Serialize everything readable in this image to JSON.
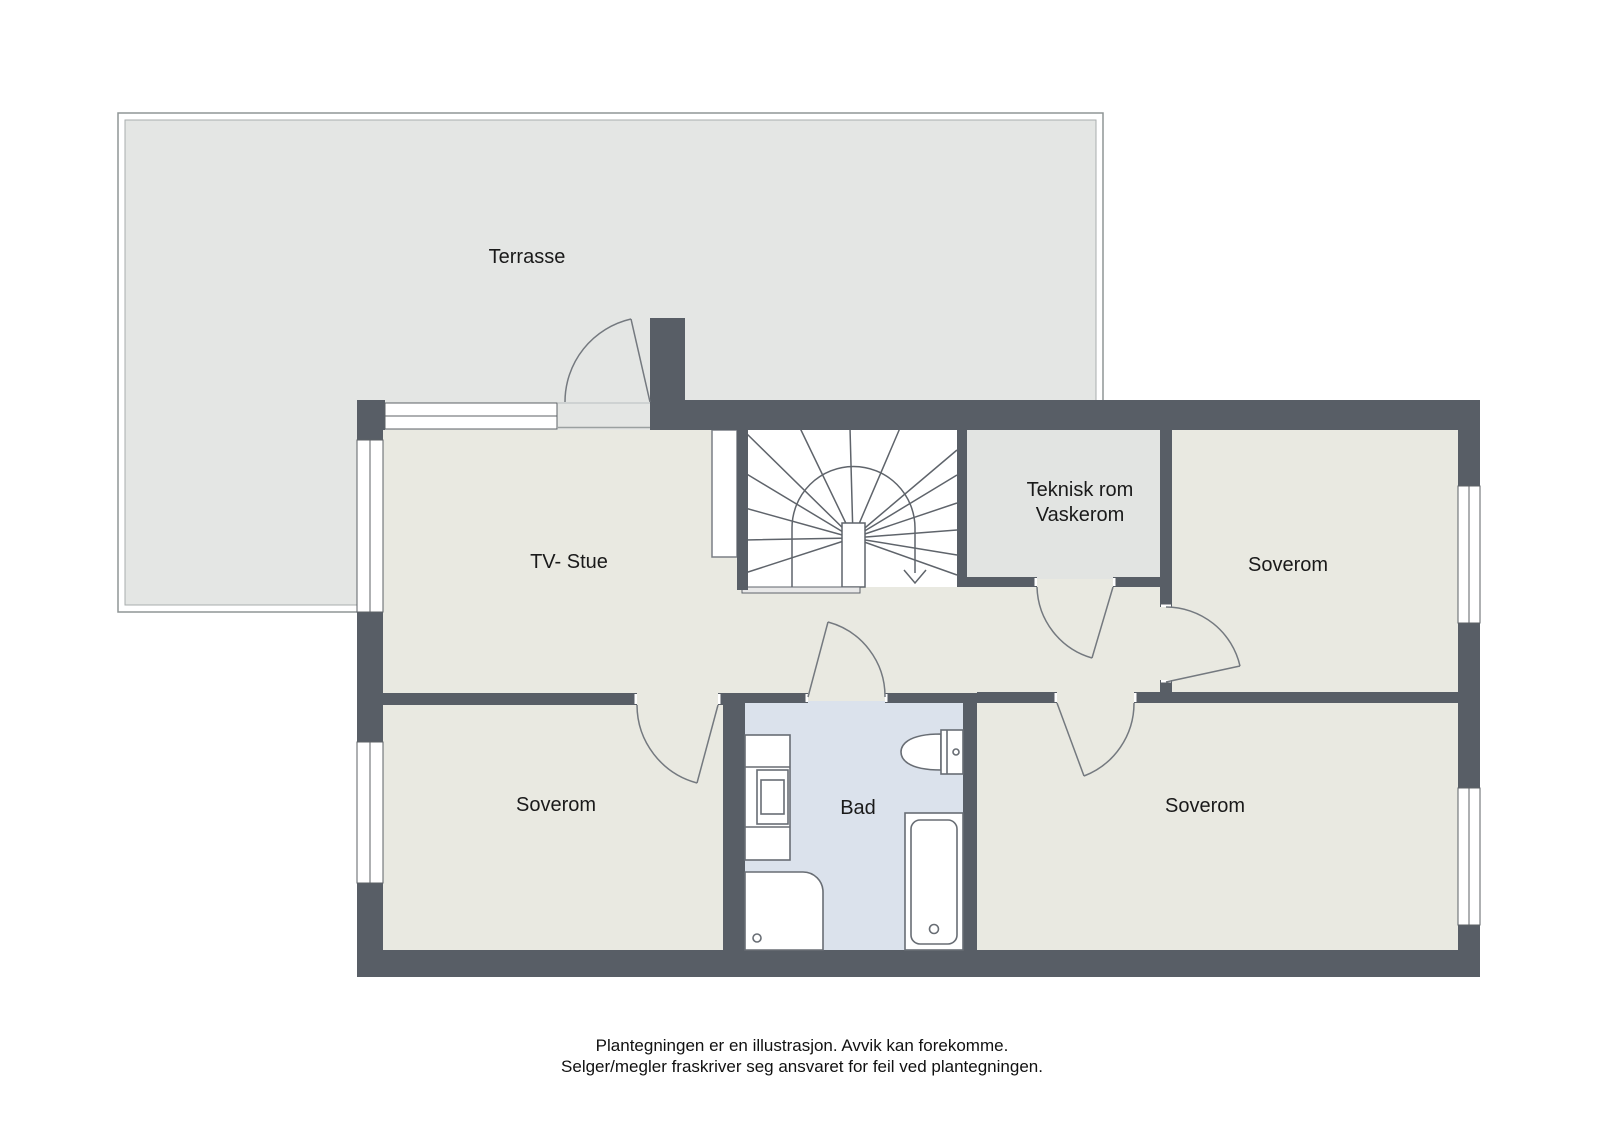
{
  "title": "Floor plan illustration",
  "rooms": {
    "terrasse": {
      "label": "Terrasse"
    },
    "tv_stue": {
      "label": "TV- Stue"
    },
    "teknisk": {
      "label_line1": "Teknisk rom",
      "label_line2": "Vaskerom"
    },
    "soverom_top_right": {
      "label": "Soverom"
    },
    "soverom_bottom_left": {
      "label": "Soverom"
    },
    "soverom_bottom_right": {
      "label": "Soverom"
    },
    "bad": {
      "label": "Bad"
    }
  },
  "stairs": {
    "direction_arrow": "down"
  },
  "disclaimer": {
    "line1": "Plantegningen er en illustrasjon. Avvik kan forekomme.",
    "line2": "Selger/megler fraskriver seg ansvaret for feil ved plantegningen."
  },
  "colors": {
    "background": "#ffffff",
    "wall": "#585e66",
    "room_floor": "#e9e9e1",
    "terrace_floor": "#e4e6e4",
    "technical_floor": "#e2e4e2",
    "bathroom_floor": "#dbe2ec",
    "outline": "#6f747b",
    "text": "#1a1a1a"
  }
}
